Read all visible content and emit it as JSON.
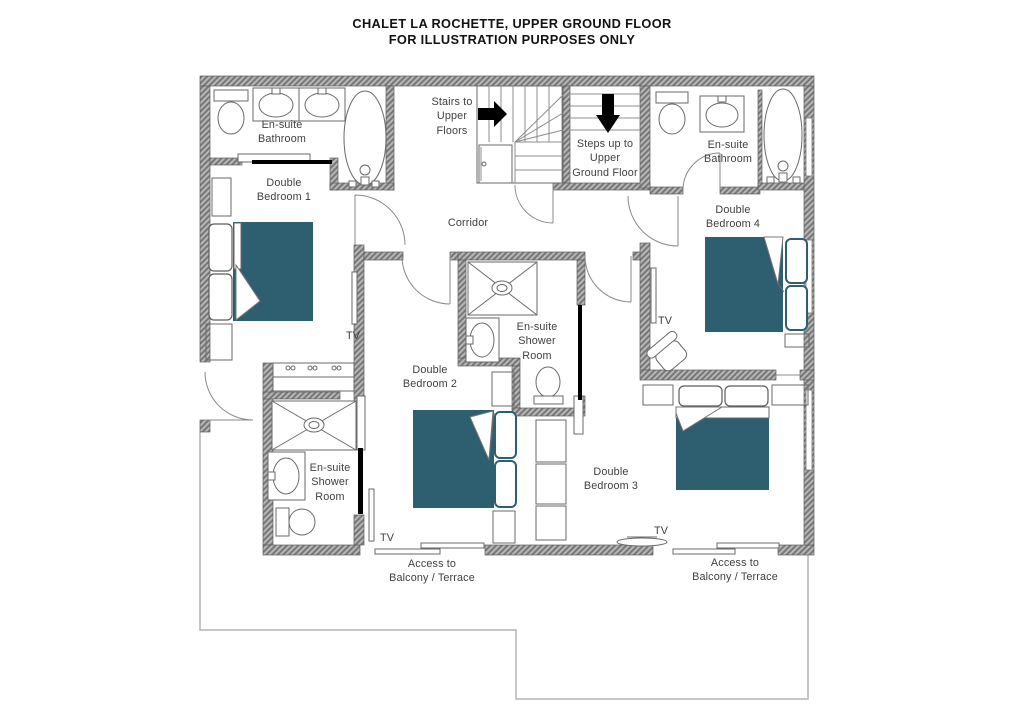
{
  "title": {
    "line1": "CHALET LA ROCHETTE, UPPER GROUND FLOOR",
    "line2": "FOR ILLUSTRATION PURPOSES ONLY"
  },
  "rooms": {
    "ensuite_bathroom_left": {
      "label": "En-suite\nBathroom"
    },
    "double_bedroom_1": {
      "label": "Double\nBedroom 1"
    },
    "stairs_to_upper": {
      "label": "Stairs to\nUpper\nFloors"
    },
    "steps_up": {
      "label": "Steps up to\nUpper\nGround Floor"
    },
    "ensuite_bathroom_right": {
      "label": "En-suite\nBathroom"
    },
    "double_bedroom_4": {
      "label": "Double\nBedroom 4"
    },
    "corridor": {
      "label": "Corridor"
    },
    "ensuite_shower_mid": {
      "label": "En-suite\nShower\nRoom"
    },
    "double_bedroom_2": {
      "label": "Double\nBedroom 2"
    },
    "ensuite_shower_left": {
      "label": "En-suite\nShower\nRoom"
    },
    "double_bedroom_3": {
      "label": "Double\nBedroom 3"
    }
  },
  "annotations": {
    "access_balcony_left": "Access to\nBalcony / Terrace",
    "access_balcony_right": "Access to\nBalcony / Terrace",
    "tv": "TV"
  },
  "colors": {
    "bed_accent": "#2d5f70",
    "wall": "#9c9c9c",
    "outline": "#6a6a6a",
    "balcony_line": "#b3b3b3"
  }
}
